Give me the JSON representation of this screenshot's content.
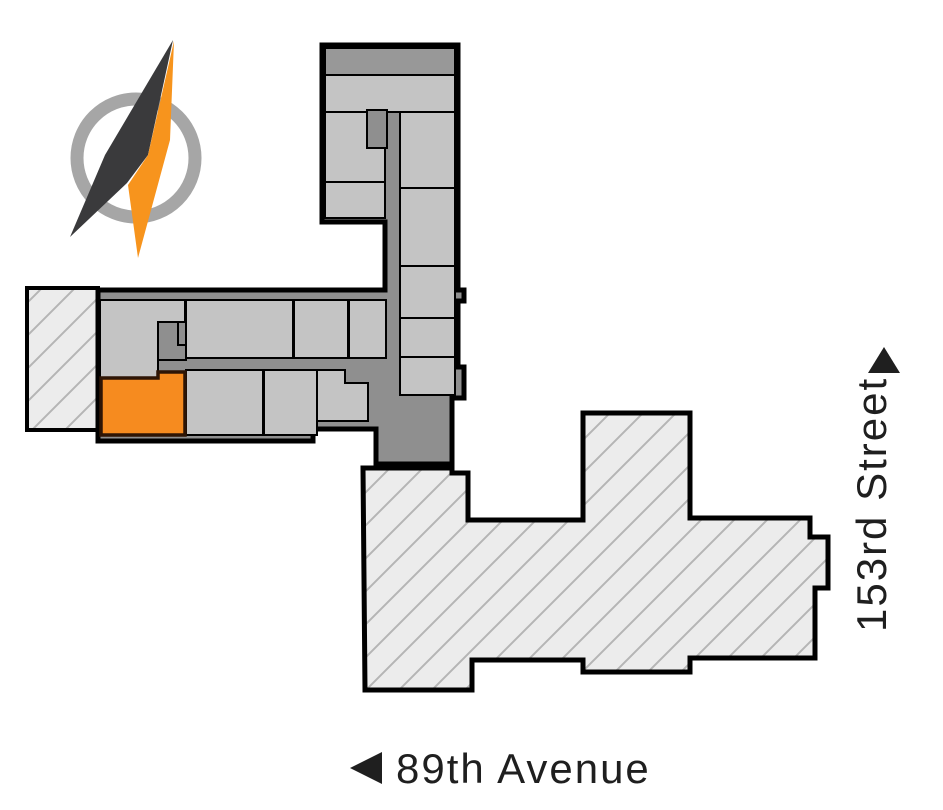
{
  "compass": {
    "icon": "compass-needle-icon",
    "ring_color": "#a6a6a6",
    "needle_primary_color": "#f7941d",
    "needle_secondary_color": "#3a3a3c"
  },
  "streets": {
    "label_color": "#1f1f1f",
    "avenue": {
      "name": "89th Avenue",
      "arrow_icon": "west-arrow-icon"
    },
    "cross_street": {
      "name": "153rd Street",
      "arrow_icon": "north-arrow-icon"
    }
  },
  "floorplan": {
    "wall_color": "#000000",
    "rooms_fill": "#c4c4c4",
    "corridor_fill": "#8f8f8f",
    "core_fill": "#989898",
    "elevator_fill": "#8f8f8f",
    "highlighted_unit": {
      "fill": "#f68b1f",
      "outline": "#2e1505"
    },
    "neighboring_buildings": {
      "fill": "#ececec",
      "hatch_color": "#b5b5b5",
      "outline": "#000000"
    }
  }
}
